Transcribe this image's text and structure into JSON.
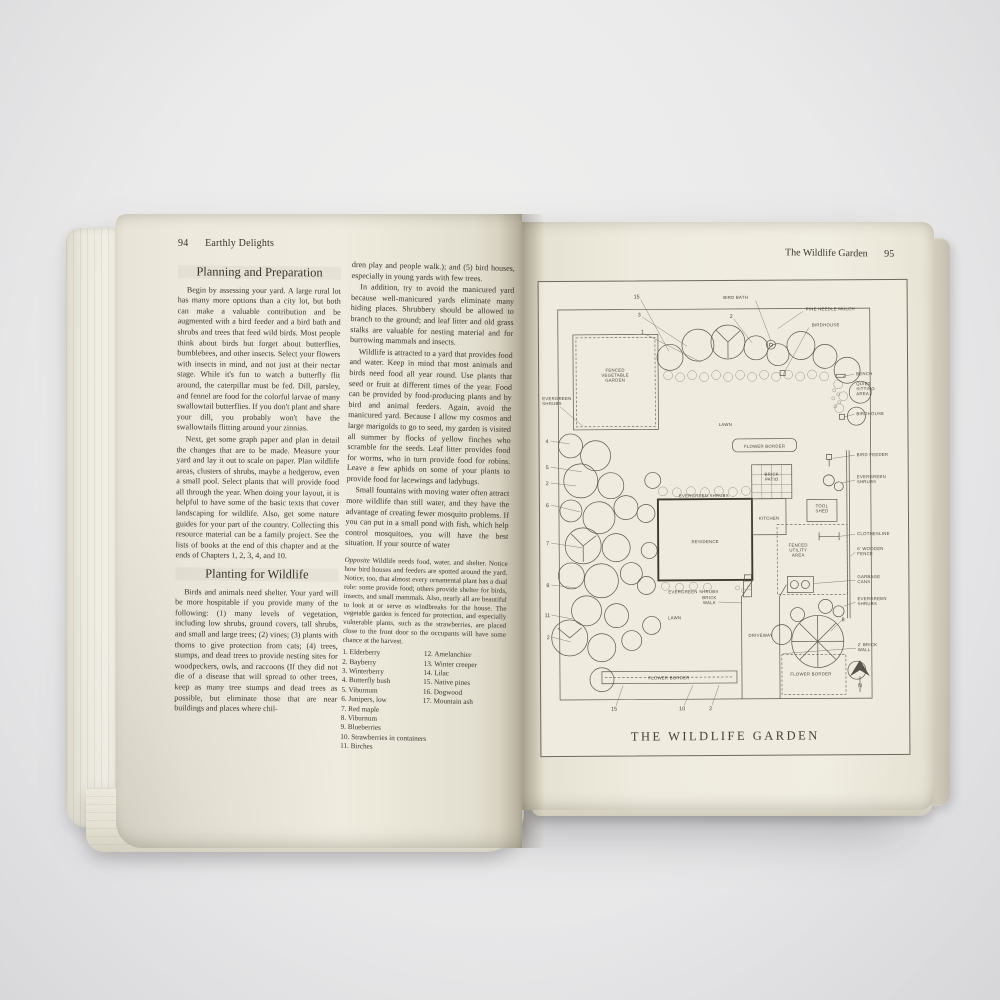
{
  "colors": {
    "paper": "#efecdf",
    "ink": "#39342c",
    "plan_ink": "#5b564b",
    "background": "#e9e9ea"
  },
  "left_page": {
    "header": {
      "page_number": "94",
      "running_title": "Earthly Delights"
    },
    "col1": {
      "heading1": "Planning and Preparation",
      "para1": "Begin by assessing your yard. A large rural lot has many more options than a city lot, but both can make a valuable contribution and be augmented with a bird feeder and a bird bath and shrubs and trees that feed wild birds. Most people think about birds but forget about butterflies, bumblebees, and other insects. Select your flowers with insects in mind, and not just at their nectar stage. While it's fun to watch a butterfly flit around, the caterpillar must be fed. Dill, parsley, and fennel are food for the colorful larvae of many swallowtail butterflies. If you don't plant and share your dill, you probably won't have the swallowtails flitting around your zinnias.",
      "para2": "Next, get some graph paper and plan in detail the changes that are to be made. Measure your yard and lay it out to scale on paper. Plan wildlife areas, clusters of shrubs, maybe a hedgerow, even a small pool. Select plants that will provide food all through the year. When doing your layout, it is helpful to have some of the basic texts that cover landscaping for wildlife. Also, get some nature guides for your part of the country. Collecting this resource material can be a family project. See the lists of books at the end of this chapter and at the ends of Chapters 1, 2, 3, 4, and 10.",
      "heading2": "Planting for Wildlife",
      "para3": "Birds and animals need shelter. Your yard will be more hospitable if you provide many of the following: (1) many levels of vegetation, including low shrubs, ground covers, tall shrubs, and small and large trees; (2) vines; (3) plants with thorns to give protection from cats; (4) trees, stumps, and dead trees to provide nesting sites for woodpeckers, owls, and raccoons (If they did not die of a disease that will spread to other trees, keep as many tree stumps and dead trees as possible, but eliminate those that are near buildings and places where chil-"
    },
    "col2": {
      "para1": "dren play and people walk.); and (5) bird houses, especially in young yards with few trees.",
      "para2": "In addition, try to avoid the manicured yard because well-manicured yards eliminate many hiding places. Shrubbery should be allowed to branch to the ground; and leaf litter and old grass stalks are valuable for nesting material and for burrowing mammals and insects.",
      "para3": "Wildlife is attracted to a yard that provides food and water. Keep in mind that most animals and birds need food all year round. Use plants that seed or fruit at different times of the year. Food can be provided by food-producing plants and by bird and animal feeders. Again, avoid the manicured yard. Because I allow my cosmos and large marigolds to go to seed, my garden is visited all summer by flocks of yellow finches who scramble for the seeds. Leaf litter provides food for worms, who in turn provide food for robins. Leave a few aphids on some of your plants to provide food for lacewings and ladybugs.",
      "para4": "Small fountains with moving water often attract more wildlife than still water, and they have the advantage of creating fewer mosquito problems. If you can put in a small pond with fish, which help control mosquitoes, you will have the best situation. If your source of water",
      "caption_lead": "Opposite",
      "caption_text": " Wildlife needs food, water, and shelter. Notice how bird houses and feeders are spotted around the yard. Notice, too, that almost every ornamental plant has a dual role: some provide food; others provide shelter for birds, insects, and small mammals. Also, nearly all are beautiful to look at or serve as windbreaks for the house. The vegetable garden is fenced for protection, and especially vulnerable plants, such as the strawberries, are placed close to the front door so the occupants will have some chance at the harvest.",
      "list_col_a": [
        "1. Elderberry",
        "2. Bayberry",
        "3. Winterberry",
        "4. Butterfly bush",
        "5. Viburnum",
        "6. Junipers, low",
        "7. Red maple",
        "8. Viburnum",
        "9. Blueberries",
        "10. Strawberries in containers",
        "11. Birches"
      ],
      "list_col_b": [
        "12. Amelanchier",
        "13. Winter creeper",
        "14. Lilac",
        "15. Native pines",
        "16. Dogwood",
        "17. Mountain ash"
      ]
    }
  },
  "right_page": {
    "header": {
      "running_title": "The Wildlife Garden",
      "page_number": "95"
    },
    "figure": {
      "caption": "THE WILDLIFE GARDEN",
      "labels": [
        {
          "t": "BIRD BATH",
          "x": 196,
          "y": 14,
          "a": "middle",
          "l": [
            216,
            16,
            231,
            56
          ]
        },
        {
          "t": "PINE NEEDLE MULCH",
          "x": 266,
          "y": 26,
          "a": "start",
          "l": [
            263,
            27,
            238,
            44
          ]
        },
        {
          "t": "BIRDHOUSE",
          "x": 272,
          "y": 42,
          "a": "start",
          "l": [
            269,
            43,
            244,
            88
          ]
        },
        {
          "t": "FENCED\nVEGETABLE\nGARDEN",
          "x": 75,
          "y": 86,
          "a": "middle"
        },
        {
          "t": "EVERGREEN\nSHRUBS",
          "x": 2,
          "y": 114,
          "a": "start",
          "l": [
            20,
            121,
            42,
            140
          ]
        },
        {
          "t": "LAWN",
          "x": 185,
          "y": 141,
          "a": "middle"
        },
        {
          "t": "BENCH",
          "x": 316,
          "y": 91,
          "a": "start",
          "l": [
            314,
            90,
            303,
            92
          ]
        },
        {
          "t": "QUIET\nSITTING\nAREA",
          "x": 316,
          "y": 101,
          "a": "start"
        },
        {
          "t": "BIRDHOUSE",
          "x": 316,
          "y": 131,
          "a": "start",
          "l": [
            314,
            130,
            303,
            133
          ]
        },
        {
          "t": "FLOWER BORDER",
          "x": 224,
          "y": 163,
          "a": "middle"
        },
        {
          "t": "BRICK\nPATIO",
          "x": 231,
          "y": 191,
          "a": "middle"
        },
        {
          "t": "KITCHEN",
          "x": 228,
          "y": 235,
          "a": "middle"
        },
        {
          "t": "EVERGREEN SHRUBS",
          "x": 163,
          "y": 212,
          "a": "middle"
        },
        {
          "t": "RESIDENCE",
          "x": 164,
          "y": 258,
          "a": "middle"
        },
        {
          "t": "EVERGREEN SHRUBS",
          "x": 152,
          "y": 308,
          "a": "middle"
        },
        {
          "t": "BIRD FEEDER",
          "x": 316,
          "y": 172,
          "a": "start",
          "l": [
            314,
            171,
            292,
            174
          ]
        },
        {
          "t": "EVERGREEN\nSHRUBS",
          "x": 316,
          "y": 194,
          "a": "start",
          "l": [
            314,
            196,
            300,
            199
          ]
        },
        {
          "t": "TOOL\nSHED",
          "x": 281,
          "y": 223,
          "a": "middle"
        },
        {
          "t": "FENCED\nUTILITY\nAREA",
          "x": 257,
          "y": 262,
          "a": "middle"
        },
        {
          "t": "CLOTHESLINE",
          "x": 316,
          "y": 251,
          "a": "start",
          "l": [
            314,
            250,
            299,
            252
          ]
        },
        {
          "t": "6' WOODEN\nFENCE",
          "x": 316,
          "y": 266,
          "a": "start",
          "l": [
            314,
            268,
            309,
            272
          ]
        },
        {
          "t": "GARBAGE\nCANS",
          "x": 316,
          "y": 294,
          "a": "start",
          "l": [
            314,
            296,
            273,
            299
          ]
        },
        {
          "t": "EVERGREEN\nSHRUBS",
          "x": 316,
          "y": 316,
          "a": "start",
          "l": [
            314,
            318,
            302,
            322
          ]
        },
        {
          "t": "BRICK\nWALK",
          "x": 168,
          "y": 314,
          "a": "middle",
          "l": [
            177,
            317,
            200,
            318
          ]
        },
        {
          "t": "DRIVEWAY",
          "x": 219,
          "y": 352,
          "a": "middle"
        },
        {
          "t": "LAWN",
          "x": 133,
          "y": 334,
          "a": "middle"
        },
        {
          "t": "FLOWER BORDER",
          "x": 127,
          "y": 394,
          "a": "middle"
        },
        {
          "t": "FLOWER BORDER",
          "x": 269,
          "y": 391,
          "a": "middle"
        },
        {
          "t": "2' BRICK\nWALL",
          "x": 316,
          "y": 362,
          "a": "start",
          "l": [
            314,
            364,
            241,
            369
          ]
        },
        {
          "t": "N",
          "x": 318,
          "y": 403,
          "a": "middle",
          "n": 1
        },
        {
          "t": "15",
          "x": 94,
          "y": 13,
          "a": "start",
          "n": 1,
          "l": [
            101,
            14,
            129,
            66
          ]
        },
        {
          "t": "3",
          "x": 98,
          "y": 31,
          "a": "start",
          "n": 1,
          "l": [
            103,
            32,
            147,
            61
          ]
        },
        {
          "t": "1",
          "x": 101,
          "y": 48,
          "a": "start",
          "n": 1,
          "l": [
            106,
            49,
            161,
            77
          ]
        },
        {
          "t": "2",
          "x": 190,
          "y": 33,
          "a": "start",
          "n": 1,
          "l": [
            194,
            34,
            212,
            58
          ]
        },
        {
          "t": "4",
          "x": 5,
          "y": 157,
          "a": "start",
          "n": 1,
          "l": [
            10,
            155,
            29,
            158
          ]
        },
        {
          "t": "5",
          "x": 5,
          "y": 183,
          "a": "start",
          "n": 1,
          "l": [
            10,
            181,
            41,
            186
          ]
        },
        {
          "t": "2",
          "x": 5,
          "y": 199,
          "a": "start",
          "n": 1,
          "l": [
            10,
            197,
            35,
            200
          ]
        },
        {
          "t": "6",
          "x": 5,
          "y": 221,
          "a": "start",
          "n": 1,
          "l": [
            10,
            219,
            39,
            226
          ]
        },
        {
          "t": "7",
          "x": 5,
          "y": 259,
          "a": "start",
          "n": 1,
          "l": [
            10,
            257,
            41,
            262
          ]
        },
        {
          "t": "8",
          "x": 5,
          "y": 301,
          "a": "start",
          "n": 1,
          "l": [
            10,
            299,
            35,
            302
          ]
        },
        {
          "t": "11",
          "x": 3,
          "y": 331,
          "a": "start",
          "n": 1,
          "l": [
            10,
            329,
            31,
            333
          ]
        },
        {
          "t": "2",
          "x": 5,
          "y": 353,
          "a": "start",
          "n": 1,
          "l": [
            10,
            351,
            29,
            356
          ]
        },
        {
          "t": "15",
          "x": 69,
          "y": 425,
          "a": "start",
          "n": 1,
          "l": [
            74,
            420,
            81,
            400
          ]
        },
        {
          "t": "10",
          "x": 137,
          "y": 425,
          "a": "start",
          "n": 1,
          "l": [
            142,
            420,
            151,
            400
          ]
        },
        {
          "t": "2",
          "x": 167,
          "y": 425,
          "a": "start",
          "n": 1,
          "l": [
            170,
            420,
            177,
            400
          ]
        },
        {
          "t": "8",
          "x": 300,
          "y": 337,
          "a": "start",
          "n": 1,
          "l": [
            302,
            334,
            289,
            347
          ]
        }
      ]
    }
  }
}
